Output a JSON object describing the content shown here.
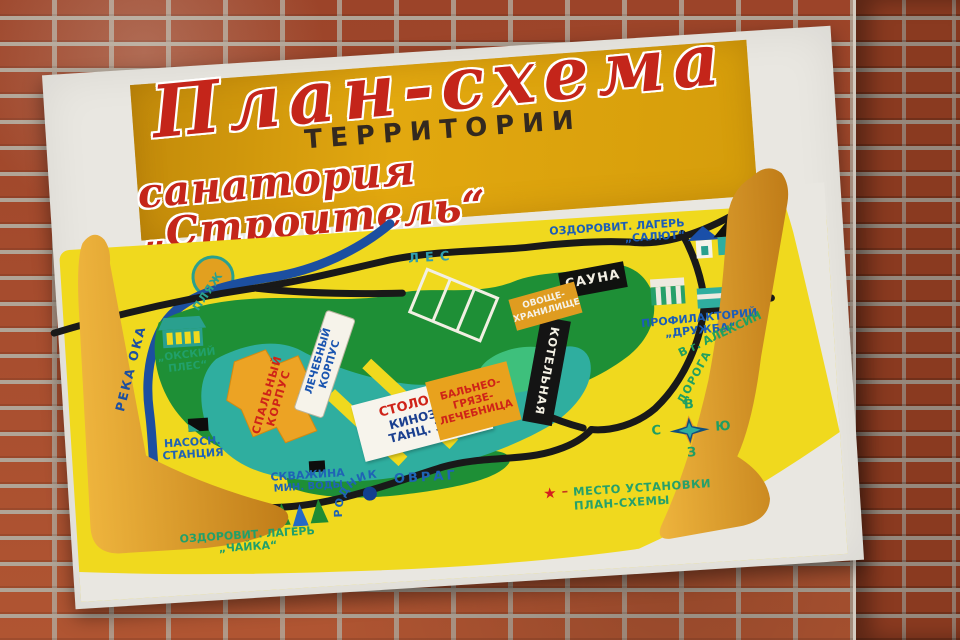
{
  "sign": {
    "title_script_top": "План-схема",
    "title_caps": "ТЕРРИТОРИИ",
    "title_script_bottom": "санатория „Строитель“"
  },
  "map": {
    "forest": "ЛЕС",
    "river": "РЕКА ОКА",
    "beach": "ПЛЯЖ",
    "okskiy_ples": {
      "line1": "„ОКСКИЙ",
      "line2": "ПЛЕС“"
    },
    "pump_station": {
      "line1": "НАСОСН.",
      "line2": "СТАНЦИЯ"
    },
    "mineral_well": {
      "line1": "СКВАЖИНА",
      "line2": "МИН. ВОДЫ"
    },
    "camp_chayka": {
      "line1": "ОЗДОРОВИТ. ЛАГЕРЬ",
      "line2": "„ЧАЙКА“"
    },
    "camp_salut": {
      "line1": "ОЗДОРОВИТ. ЛАГЕРЬ",
      "line2": "„САЛЮТ“"
    },
    "sleeping_korpus": {
      "line1": "СПАЛЬНЫЙ",
      "line2": "КОРПУС"
    },
    "medical_korpus": {
      "line1": "ЛЕЧЕБНЫЙ",
      "line2": "КОРПУС"
    },
    "canteen": {
      "line1": "СТОЛОВАЯ",
      "line2": "КИНОЗАЛ",
      "line3": "ТАНЦ. ЗАЛ"
    },
    "balneo": {
      "line1": "БАЛЬНЕО-",
      "line2": "ГРЯЗЕ-",
      "line3": "ЛЕЧЕБНИЦА"
    },
    "boiler": "КОТЕЛЬНАЯ",
    "sauna": "САУНА",
    "vegetable_store": {
      "line1": "ОВОЩЕ-",
      "line2": "ХРАНИЛИЩЕ"
    },
    "prophylactory": {
      "line1": "ПРОФИЛАКТОРИЙ",
      "line2": "„ДРУЖБА“"
    },
    "road": "ДОРОГА",
    "to_aleksin": "В г. АЛЕКСИН",
    "ravine": "ОВРАГ",
    "spring": "РОДНИК",
    "compass": {
      "east": "В",
      "north": "С",
      "south": "Ю",
      "west": "З"
    },
    "legend": {
      "star": "★",
      "dash": "–",
      "line1": "МЕСТО УСТАНОВКИ",
      "line2": "ПЛАН-СХЕМЫ"
    }
  },
  "colors": {
    "banner_orange": "#e2a80f",
    "map_yellow": "#f0d91e",
    "forest_green": "#1e8f36",
    "territory_teal": "#2fae9f",
    "river_blue": "#1c4fa0",
    "road_black": "#191919",
    "curl_orange": "#d99a26",
    "label_blue": "#1f63b5",
    "label_green": "#21a06a",
    "label_red": "#cf2318"
  }
}
